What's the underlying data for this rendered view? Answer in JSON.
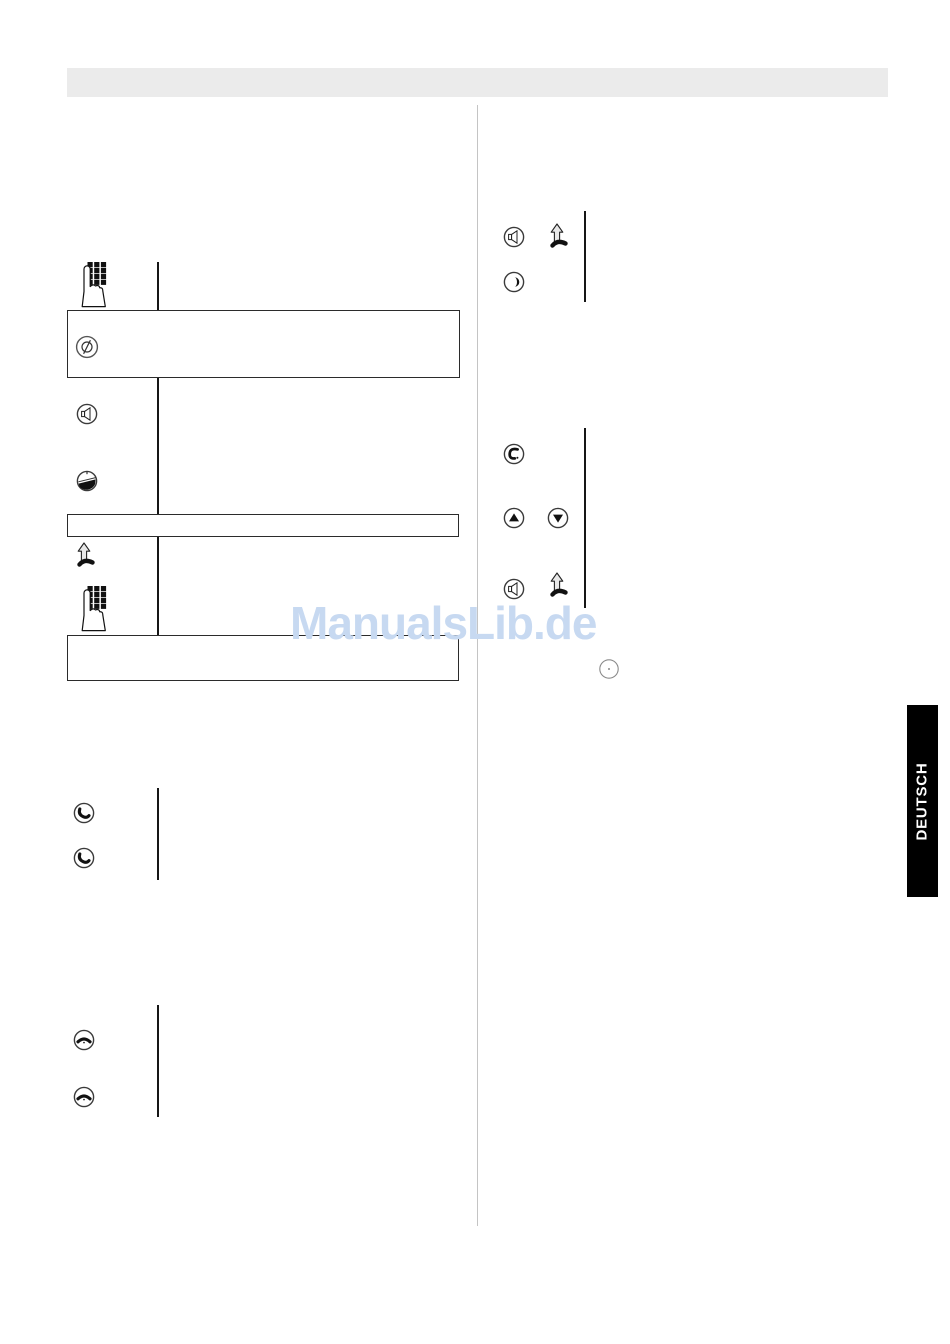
{
  "page": {
    "background": "#ffffff",
    "divider_color": "#c4c4c4",
    "connector_line_color": "#161616",
    "box_border_color": "#2b2b2b"
  },
  "header_bar": {
    "color": "#ebebeb"
  },
  "watermark": {
    "text": "ManualsLib.de",
    "color": "#c7d9f1"
  },
  "side_tab": {
    "label": "DEUTSCH",
    "background": "#000000",
    "text_color": "#ffffff"
  },
  "left_column": {
    "rows": [
      {
        "icons": [
          "keypad-press-icon"
        ],
        "connector": true
      },
      {
        "box": true,
        "icons": [
          "blocked-icon"
        ]
      },
      {
        "icons": [
          "speaker-icon"
        ],
        "connector": true
      },
      {
        "icons": [
          "handset-down-icon"
        ],
        "connector": true
      },
      {
        "box": true,
        "icons": []
      },
      {
        "icons": [
          "lift-handset-icon"
        ],
        "connector": true
      },
      {
        "icons": [
          "keypad-press-icon"
        ],
        "connector": true
      },
      {
        "box": true,
        "icons": []
      },
      {
        "icons": [
          "answer-call-icon"
        ],
        "connector": true
      },
      {
        "icons": [
          "answer-call-icon"
        ],
        "connector": true
      },
      {
        "icons": [
          "hang-up-icon"
        ],
        "connector": true
      },
      {
        "icons": [
          "hang-up-icon"
        ],
        "connector": true
      }
    ]
  },
  "right_column": {
    "rows": [
      {
        "icons": [
          "speaker-icon",
          "lift-handset-icon"
        ],
        "connector": true
      },
      {
        "icons": [
          "contrast-icon"
        ],
        "connector": true
      },
      {
        "icons": [
          "phone-call-icon"
        ],
        "connector": true
      },
      {
        "icons": [
          "scroll-up-icon",
          "scroll-down-icon"
        ],
        "connector": true
      },
      {
        "icons": [
          "speaker-icon",
          "lift-handset-icon"
        ],
        "connector": true
      },
      {
        "icons": [
          "key-circle-icon"
        ],
        "connector": false
      }
    ]
  }
}
